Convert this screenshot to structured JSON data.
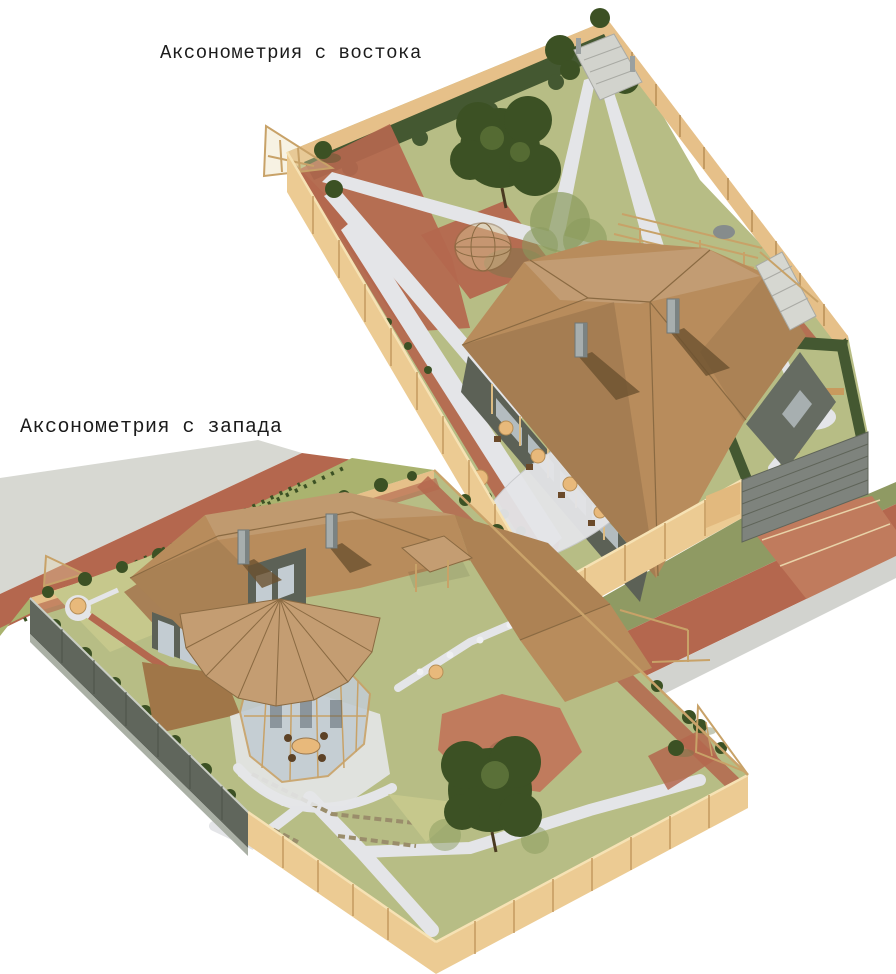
{
  "figures": {
    "east": {
      "label": "Аксонометрия с востока"
    },
    "west": {
      "label": "Аксонометрия с запада"
    }
  },
  "colors": {
    "background": "#ffffff",
    "text": "#1b1b1b",
    "lawn": "#b7bd85",
    "lawn_bright": "#c6c88c",
    "verge": "#8f9a63",
    "foliage_dark": "#3c5124",
    "foliage_light": "#8a9b5e",
    "paving_red": "#b4674e",
    "paving_red_light": "#c07b5d",
    "path": "#e4e5e8",
    "road_gray": "#d7d8d2",
    "shadow_gray": "#d2d3cf",
    "fence_tan": "#eccb93",
    "fence_tan_inner": "#e6c089",
    "wood": "#c8a268",
    "wood_dark": "#8a6a42",
    "roof": "#b88c5c",
    "roof_fan": "#c49d72",
    "roof_dark": "#a07648",
    "wall_gray": "#5c6156",
    "wall_gray_light": "#666c62",
    "gray_fence": "#60665c",
    "gate_gray": "#7e837d",
    "glass": "#c3ccd2",
    "chimney": "#a7aeae",
    "hedge": "#445831",
    "table_tan": "#e8b97b",
    "stone": "#9a8d6b"
  }
}
